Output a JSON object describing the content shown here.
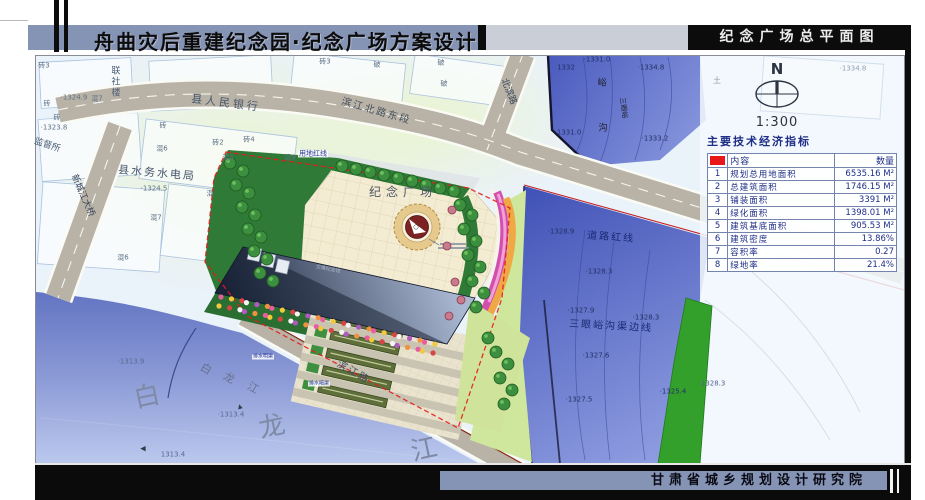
{
  "header": {
    "title": "舟曲灾后重建纪念园·纪念广场方案设计",
    "sheet_title": "纪念广场总平面图"
  },
  "footer": {
    "institute": "甘肃省城乡规划设计研究院"
  },
  "compass": {
    "north_label": "N",
    "scale": "1:300"
  },
  "indicator_table": {
    "title": "主要技术经济指标",
    "columns": [
      "",
      "内容",
      "数量"
    ],
    "rows": [
      [
        "1",
        "规划总用地面积",
        "6535.16 M²"
      ],
      [
        "2",
        "总建筑面积",
        "1746.15 M²"
      ],
      [
        "3",
        "铺装面积",
        "3391 M²"
      ],
      [
        "4",
        "绿化面积",
        "1398.01 M²"
      ],
      [
        "5",
        "建筑基底面积",
        "905.53 M²"
      ],
      [
        "6",
        "建筑密度",
        "13.86%"
      ],
      [
        "7",
        "容积率",
        "0.27"
      ],
      [
        "8",
        "绿地率",
        "21.4%"
      ]
    ]
  },
  "colors": {
    "title_band": "#8593b4",
    "black_bar": "#0c0c0c",
    "table_red": "#e81818",
    "red_line": "#e51c1c",
    "river": "#8b9ad6",
    "channel": "#5a6cc8",
    "plaza_paving": "#f3ecd2",
    "greenery": "#2e7a36",
    "road": "#b8b3a6"
  },
  "map_labels": [
    {
      "t": "砖3",
      "x": 44,
      "y": 66
    },
    {
      "t": "联社楼",
      "x": 114,
      "y": 82,
      "v": 1,
      "s": 9,
      "c": "#4f6078"
    },
    {
      "t": "·1324.9",
      "x": 74,
      "y": 98
    },
    {
      "t": "混7",
      "x": 97,
      "y": 99
    },
    {
      "t": "砖",
      "x": 47,
      "y": 104
    },
    {
      "t": "砖",
      "x": 57,
      "y": 118
    },
    {
      "t": "·1323.8",
      "x": 54,
      "y": 128
    },
    {
      "t": "监督所",
      "x": 47,
      "y": 146,
      "s": 9,
      "r": 18,
      "c": "#4f6078"
    },
    {
      "t": "县人民银行",
      "x": 226,
      "y": 103,
      "s": 11,
      "r": 7,
      "ls": 3,
      "c": "#46566c"
    },
    {
      "t": "砖",
      "x": 163,
      "y": 126
    },
    {
      "t": "砖2",
      "x": 218,
      "y": 143
    },
    {
      "t": "砖4",
      "x": 249,
      "y": 140
    },
    {
      "t": "混5",
      "x": 228,
      "y": 158
    },
    {
      "t": "混9",
      "x": 290,
      "y": 158
    },
    {
      "t": "混6",
      "x": 162,
      "y": 149
    },
    {
      "t": "县水务水电局",
      "x": 157,
      "y": 173,
      "s": 11,
      "r": 5,
      "ls": 2,
      "c": "#46566c"
    },
    {
      "t": "·1324.5",
      "x": 154,
      "y": 189
    },
    {
      "t": "混7",
      "x": 156,
      "y": 218
    },
    {
      "t": "混6",
      "x": 123,
      "y": 258
    },
    {
      "t": "混",
      "x": 210,
      "y": 194
    },
    {
      "t": "砖3",
      "x": 325,
      "y": 62
    },
    {
      "t": "破",
      "x": 377,
      "y": 65
    },
    {
      "t": "破",
      "x": 441,
      "y": 63
    },
    {
      "t": "破",
      "x": 444,
      "y": 84
    },
    {
      "t": "滨江北路东段",
      "x": 376,
      "y": 112,
      "s": 10,
      "r": 16,
      "ls": 2,
      "c": "#454f5e"
    },
    {
      "t": "北滨路",
      "x": 508,
      "y": 92,
      "s": 9,
      "r": 68,
      "c": "#39455a"
    },
    {
      "t": "新城江大桥",
      "x": 82,
      "y": 196,
      "s": 9,
      "r": 66,
      "c": "#39455a"
    },
    {
      "t": "用地红线",
      "x": 313,
      "y": 154,
      "s": 7,
      "c": "#27379a",
      "bg": 1
    },
    {
      "t": "纪念广场",
      "x": 403,
      "y": 192,
      "s": 12,
      "ls": 5,
      "c": "#4d5564",
      "w": 500
    },
    {
      "t": "灾难纪念馆",
      "x": 328,
      "y": 270,
      "s": 5,
      "r": 11,
      "c": "#aeb6c6"
    },
    {
      "t": "滨江路",
      "x": 353,
      "y": 373,
      "s": 10,
      "r": 30,
      "ls": 2,
      "c": "#45505e"
    },
    {
      "t": "排水明渠",
      "x": 263,
      "y": 357,
      "s": 5,
      "c": "#27379a",
      "bg": 1
    },
    {
      "t": "排水暗渠",
      "x": 319,
      "y": 384,
      "s": 5,
      "c": "#27379a",
      "bg": 1
    },
    {
      "t": "道路红线",
      "x": 611,
      "y": 238,
      "s": 10,
      "r": 4,
      "ls": 2,
      "c": "#1b2a72"
    },
    {
      "t": "·1328.9",
      "x": 561,
      "y": 232,
      "c": "#243064"
    },
    {
      "t": "·1328.3",
      "x": 599,
      "y": 272,
      "c": "#243064"
    },
    {
      "t": "·1327.9",
      "x": 581,
      "y": 311,
      "c": "#243064"
    },
    {
      "t": "·1328.3",
      "x": 646,
      "y": 318,
      "c": "#243064"
    },
    {
      "t": "三眼峪沟渠边线",
      "x": 611,
      "y": 327,
      "s": 10,
      "r": 3,
      "ls": 2,
      "c": "#1b2a72"
    },
    {
      "t": "·1327.6",
      "x": 596,
      "y": 356,
      "c": "#243064"
    },
    {
      "t": "·1325.4",
      "x": 673,
      "y": 392,
      "c": "#243064"
    },
    {
      "t": "·1327.5",
      "x": 579,
      "y": 400,
      "c": "#243064"
    },
    {
      "t": "·1328.3",
      "x": 712,
      "y": 384,
      "c": "#54648e"
    },
    {
      "t": "·1331.0",
      "x": 597,
      "y": 60,
      "c": "#243064"
    },
    {
      "t": "1332",
      "x": 566,
      "y": 68,
      "c": "#243064"
    },
    {
      "t": "·1334.8",
      "x": 651,
      "y": 68,
      "c": "#243064"
    },
    {
      "t": "峪",
      "x": 602,
      "y": 84,
      "s": 9,
      "c": "#1c1c28"
    },
    {
      "t": "沟",
      "x": 603,
      "y": 129,
      "s": 9,
      "c": "#1c1c28"
    },
    {
      "t": "三眼峪",
      "x": 623,
      "y": 108,
      "s": 7,
      "r": 82,
      "c": "#1c1c28"
    },
    {
      "t": "·1331.0",
      "x": 568,
      "y": 133,
      "c": "#243064"
    },
    {
      "t": "·1333.2",
      "x": 655,
      "y": 139,
      "c": "#243064"
    },
    {
      "t": "·1334.8",
      "x": 853,
      "y": 69,
      "c": "#90a0b2"
    },
    {
      "t": "土",
      "x": 717,
      "y": 81,
      "s": 8,
      "c": "#90a0b2"
    },
    {
      "t": "白",
      "x": 147,
      "y": 397,
      "s": 26,
      "r": -12,
      "c": "#7e89a6",
      "w": 500
    },
    {
      "t": "龙",
      "x": 272,
      "y": 427,
      "s": 26,
      "r": -12,
      "c": "#7e89a6",
      "w": 500
    },
    {
      "t": "江",
      "x": 424,
      "y": 450,
      "s": 26,
      "r": -12,
      "c": "#7e89a6",
      "w": 500
    },
    {
      "t": "白",
      "x": 206,
      "y": 369,
      "s": 11,
      "r": 30,
      "c": "#66718e"
    },
    {
      "t": "龙",
      "x": 229,
      "y": 378,
      "s": 11,
      "r": 30,
      "c": "#66718e"
    },
    {
      "t": "江",
      "x": 253,
      "y": 388,
      "s": 11,
      "r": 30,
      "c": "#66718e"
    },
    {
      "t": "·1313.9",
      "x": 131,
      "y": 362,
      "c": "#5a6a92"
    },
    {
      "t": "·1313.4",
      "x": 231,
      "y": 415,
      "c": "#5a6a92"
    },
    {
      "t": "1313.4",
      "x": 173,
      "y": 455,
      "c": "#5a6a92"
    },
    {
      "t": "◀",
      "x": 143,
      "y": 449,
      "s": 7,
      "c": "#333a4a"
    },
    {
      "t": "▲",
      "x": 240,
      "y": 407,
      "s": 6,
      "r": -15,
      "c": "#333a4a"
    }
  ]
}
